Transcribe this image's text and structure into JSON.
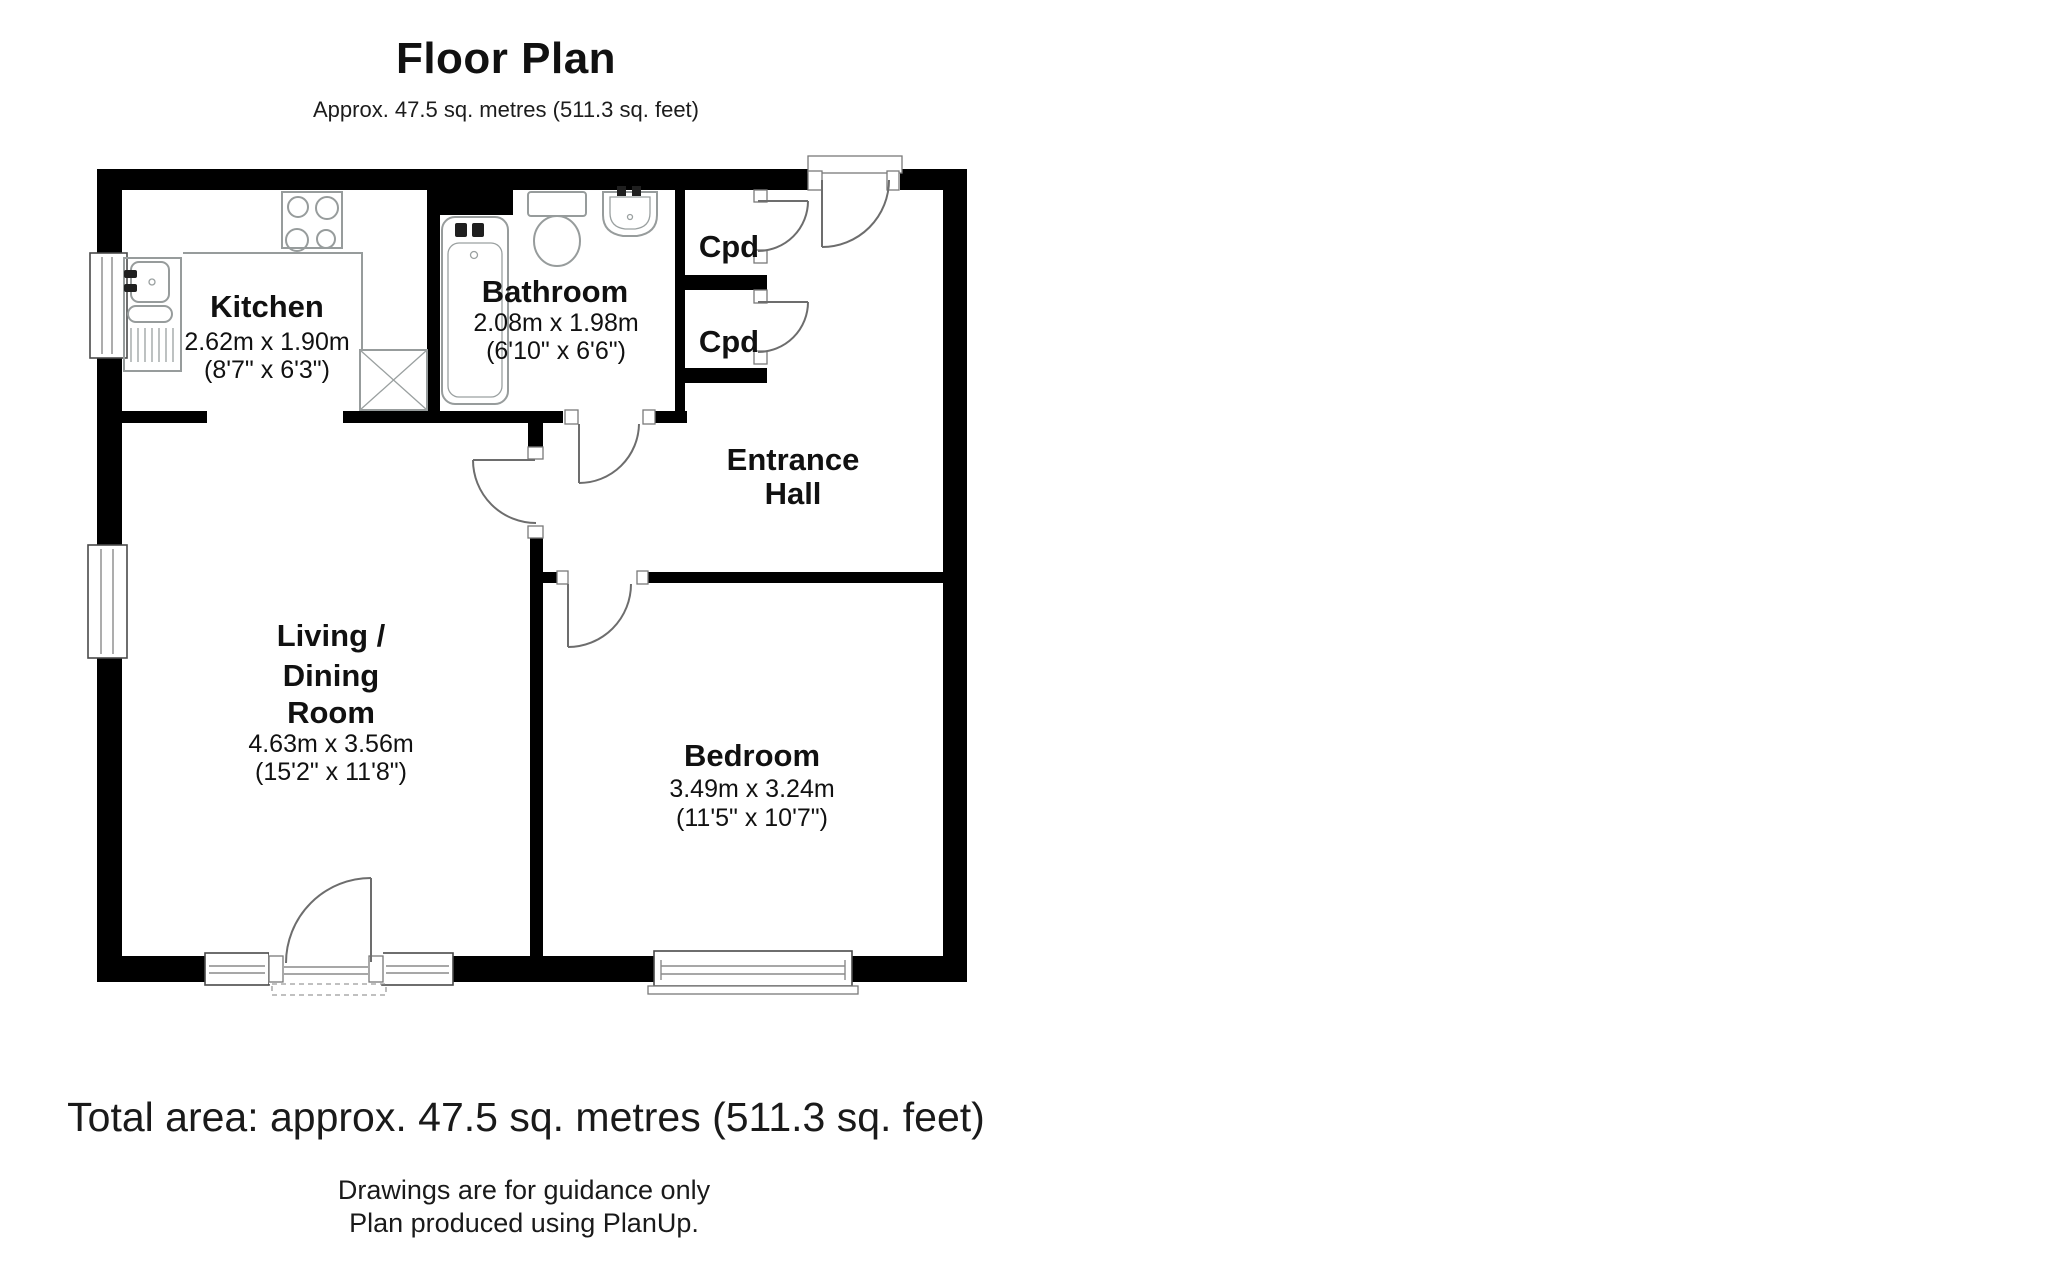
{
  "title": {
    "heading": "Floor Plan",
    "subtitle": "Approx. 47.5 sq. metres (511.3 sq. feet)"
  },
  "rooms": {
    "kitchen": {
      "name": "Kitchen",
      "size_metric": "2.62m x 1.90m",
      "size_imperial": "(8'7\" x 6'3\")"
    },
    "bathroom": {
      "name": "Bathroom",
      "size_metric": "2.08m x 1.98m",
      "size_imperial": "(6'10\" x 6'6\")"
    },
    "cupboard_top": {
      "name": "Cpd"
    },
    "cupboard_bottom": {
      "name": "Cpd"
    },
    "entrance_hall": {
      "name_line1": "Entrance",
      "name_line2": "Hall"
    },
    "living_dining": {
      "name_line1": "Living /",
      "name_line2": "Dining",
      "name_line3": "Room",
      "size_metric": "4.63m x 3.56m",
      "size_imperial": "(15'2\" x 11'8\")"
    },
    "bedroom": {
      "name": "Bedroom",
      "size_metric": "3.49m x 3.24m",
      "size_imperial": "(11'5\" x 10'7\")"
    }
  },
  "footer": {
    "total_area": "Total area: approx. 47.5 sq. metres (511.3 sq. feet)",
    "disclaimer": "Drawings are for guidance only",
    "credit": "Plan produced using PlanUp."
  },
  "colors": {
    "wall": "#000000",
    "fixture": "#979c9c",
    "door_swing": "#6d6d6d",
    "background": "#ffffff"
  }
}
